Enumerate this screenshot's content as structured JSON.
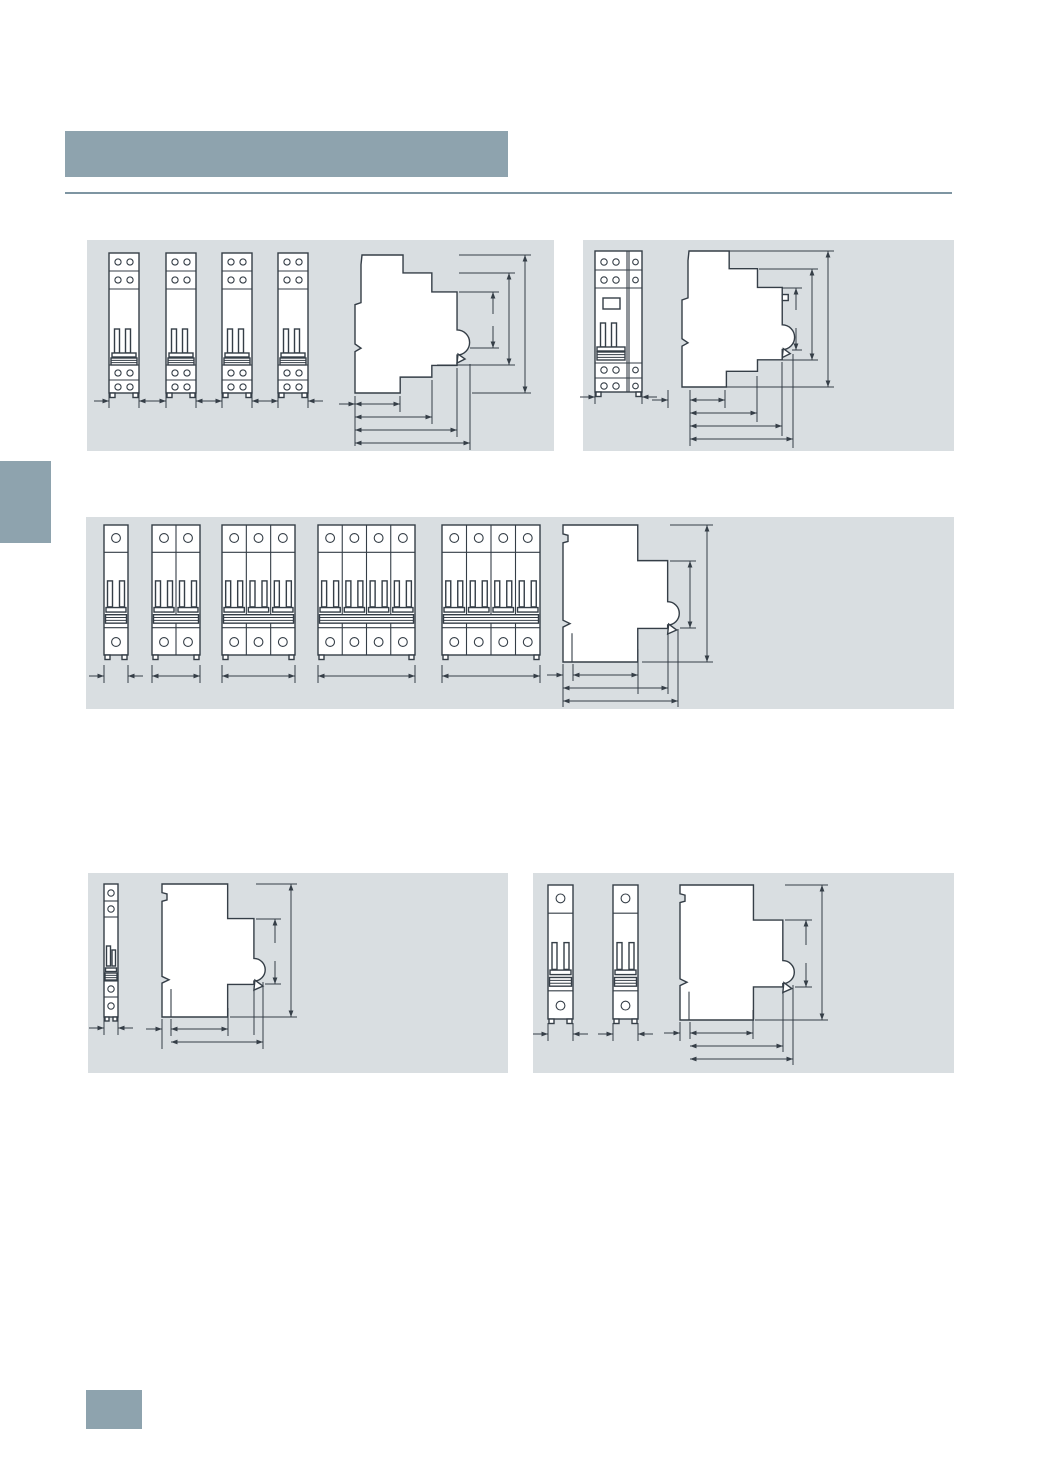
{
  "page": {
    "width": 1041,
    "height": 1472,
    "background": "#ffffff"
  },
  "colors": {
    "accent_block": "#8ea3ae",
    "panel_background": "#d9dee1",
    "rule_line": "#7e95a2",
    "drawing_line": "#353e47",
    "drawing_fill": "#ffffff"
  },
  "header": {
    "title_bar": {
      "x": 65,
      "y": 131,
      "w": 443,
      "h": 46
    },
    "rule": {
      "x": 65,
      "y": 192,
      "w": 887
    }
  },
  "side_tab": {
    "x": 0,
    "y": 461,
    "w": 51,
    "h": 82
  },
  "page_marker": {
    "x": 86,
    "y": 1390,
    "w": 56,
    "h": 39
  },
  "panels": [
    {
      "id": "top-left",
      "box": {
        "x": 87,
        "y": 240,
        "w": 467,
        "h": 211
      },
      "figures": [
        {
          "kind": "front",
          "style": "dd",
          "x": 22,
          "y": 13,
          "w": 30,
          "h": 140
        },
        {
          "kind": "front",
          "style": "dd",
          "x": 79,
          "y": 13,
          "w": 30,
          "h": 140
        },
        {
          "kind": "front",
          "style": "dd",
          "x": 135,
          "y": 13,
          "w": 30,
          "h": 140
        },
        {
          "kind": "front",
          "style": "dd",
          "x": 191,
          "y": 13,
          "w": 30,
          "h": 140
        },
        {
          "kind": "profile",
          "variant": "rcbo",
          "x": 268,
          "y": 15,
          "w": 113,
          "h": 138,
          "button": false
        }
      ],
      "dims": [
        {
          "t": "ext",
          "x": 22,
          "y1": 150,
          "y2": 168
        },
        {
          "t": "ext",
          "x": 52,
          "y1": 150,
          "y2": 168
        },
        {
          "t": "ext",
          "x": 79,
          "y1": 150,
          "y2": 168
        },
        {
          "t": "ext",
          "x": 109,
          "y1": 150,
          "y2": 168
        },
        {
          "t": "ext",
          "x": 135,
          "y1": 150,
          "y2": 168
        },
        {
          "t": "ext",
          "x": 165,
          "y1": 150,
          "y2": 168
        },
        {
          "t": "ext",
          "x": 191,
          "y1": 150,
          "y2": 168
        },
        {
          "t": "ext",
          "x": 221,
          "y1": 150,
          "y2": 168
        },
        {
          "t": "h",
          "mode": "out",
          "x1": 22,
          "x2": 52,
          "y": 161
        },
        {
          "t": "h",
          "mode": "out",
          "x1": 79,
          "x2": 109,
          "y": 161
        },
        {
          "t": "h",
          "mode": "out",
          "x1": 135,
          "x2": 165,
          "y": 161
        },
        {
          "t": "h",
          "mode": "out",
          "x1": 191,
          "x2": 221,
          "y": 161
        },
        {
          "t": "href",
          "x1": 372,
          "y1": 15,
          "x2": 444,
          "y2": 15
        },
        {
          "t": "href",
          "x1": 385,
          "y1": 153,
          "x2": 444,
          "y2": 153
        },
        {
          "t": "href",
          "x1": 372,
          "y1": 33,
          "x2": 428,
          "y2": 33
        },
        {
          "t": "href",
          "x1": 350,
          "y1": 125,
          "x2": 428,
          "y2": 125
        },
        {
          "t": "href",
          "x1": 372,
          "y1": 52,
          "x2": 412,
          "y2": 52
        },
        {
          "t": "href",
          "x1": 383,
          "y1": 108,
          "x2": 412,
          "y2": 108
        },
        {
          "t": "v",
          "x": 438,
          "y1": 15,
          "y2": 153,
          "heads": "both"
        },
        {
          "t": "v",
          "x": 422,
          "y1": 33,
          "y2": 125,
          "heads": "both"
        },
        {
          "t": "v",
          "x": 406,
          "y1": 52,
          "y2": 74,
          "heads": "top"
        },
        {
          "t": "v",
          "x": 406,
          "y1": 86,
          "y2": 108,
          "heads": "bottom"
        },
        {
          "t": "ext",
          "x": 268,
          "y1": 156,
          "y2": 206
        },
        {
          "t": "ext",
          "x": 313,
          "y1": 156,
          "y2": 172
        },
        {
          "t": "ext",
          "x": 345,
          "y1": 140,
          "y2": 184
        },
        {
          "t": "ext",
          "x": 370,
          "y1": 128,
          "y2": 197
        },
        {
          "t": "ext",
          "x": 383,
          "y1": 124,
          "y2": 210
        },
        {
          "t": "h",
          "mode": "right",
          "x1": 252,
          "x2": 268,
          "y": 164
        },
        {
          "t": "h",
          "mode": "in",
          "x1": 268,
          "x2": 313,
          "y": 164
        },
        {
          "t": "h",
          "mode": "in",
          "x1": 268,
          "x2": 345,
          "y": 177
        },
        {
          "t": "h",
          "mode": "in",
          "x1": 268,
          "x2": 370,
          "y": 190
        },
        {
          "t": "h",
          "mode": "in",
          "x1": 268,
          "x2": 383,
          "y": 203
        }
      ]
    },
    {
      "id": "top-right",
      "box": {
        "x": 583,
        "y": 240,
        "w": 371,
        "h": 211
      },
      "figures": [
        {
          "kind": "front",
          "style": "rcbo",
          "x": 12,
          "y": 11,
          "w": 47,
          "h": 141
        },
        {
          "kind": "profile",
          "variant": "rcbo",
          "x": 99,
          "y": 11,
          "w": 111,
          "h": 136,
          "button": true
        }
      ],
      "dims": [
        {
          "t": "ext",
          "x": 12,
          "y1": 148,
          "y2": 164
        },
        {
          "t": "ext",
          "x": 59,
          "y1": 148,
          "y2": 164
        },
        {
          "t": "h",
          "mode": "out",
          "x1": 12,
          "x2": 59,
          "y": 157
        },
        {
          "t": "href",
          "x1": 146,
          "y1": 11,
          "x2": 251,
          "y2": 11
        },
        {
          "t": "href",
          "x1": 144,
          "y1": 147,
          "x2": 251,
          "y2": 147
        },
        {
          "t": "href",
          "x1": 176,
          "y1": 29,
          "x2": 235,
          "y2": 29
        },
        {
          "t": "href",
          "x1": 176,
          "y1": 120,
          "x2": 235,
          "y2": 120
        },
        {
          "t": "href",
          "x1": 199,
          "y1": 48,
          "x2": 219,
          "y2": 48
        },
        {
          "t": "href",
          "x1": 209,
          "y1": 110,
          "x2": 219,
          "y2": 110
        },
        {
          "t": "v",
          "x": 245,
          "y1": 11,
          "y2": 147,
          "heads": "both"
        },
        {
          "t": "v",
          "x": 229,
          "y1": 29,
          "y2": 120,
          "heads": "both"
        },
        {
          "t": "v",
          "x": 213,
          "y1": 48,
          "y2": 70,
          "heads": "top"
        },
        {
          "t": "v",
          "x": 213,
          "y1": 88,
          "y2": 110,
          "heads": "bottom"
        },
        {
          "t": "ext",
          "x": 85,
          "y1": 150,
          "y2": 168
        },
        {
          "t": "ext",
          "x": 107,
          "y1": 150,
          "y2": 206
        },
        {
          "t": "ext",
          "x": 142,
          "y1": 150,
          "y2": 168
        },
        {
          "t": "ext",
          "x": 174,
          "y1": 136,
          "y2": 182
        },
        {
          "t": "ext",
          "x": 199,
          "y1": 122,
          "y2": 196
        },
        {
          "t": "ext",
          "x": 210,
          "y1": 114,
          "y2": 208
        },
        {
          "t": "h",
          "mode": "right",
          "x1": 69,
          "x2": 85,
          "y": 160
        },
        {
          "t": "h",
          "mode": "in",
          "x1": 107,
          "x2": 142,
          "y": 160
        },
        {
          "t": "h",
          "mode": "in",
          "x1": 107,
          "x2": 174,
          "y": 173
        },
        {
          "t": "h",
          "mode": "in",
          "x1": 107,
          "x2": 199,
          "y": 186
        },
        {
          "t": "h",
          "mode": "in",
          "x1": 107,
          "x2": 210,
          "y": 199
        }
      ]
    },
    {
      "id": "middle",
      "box": {
        "x": 86,
        "y": 517,
        "w": 868,
        "h": 192
      },
      "figures": [
        {
          "kind": "front",
          "style": "std",
          "x": 18,
          "y": 8,
          "w": 24,
          "h": 130,
          "modules": 1
        },
        {
          "kind": "front",
          "style": "std",
          "x": 66,
          "y": 8,
          "w": 48,
          "h": 130,
          "modules": 2
        },
        {
          "kind": "front",
          "style": "std",
          "x": 136,
          "y": 8,
          "w": 73,
          "h": 130,
          "modules": 3
        },
        {
          "kind": "front",
          "style": "std",
          "x": 232,
          "y": 8,
          "w": 97,
          "h": 130,
          "modules": 4
        },
        {
          "kind": "front",
          "style": "std",
          "x": 356,
          "y": 8,
          "w": 98,
          "h": 130,
          "modules": 4
        },
        {
          "kind": "profile",
          "variant": "mcb",
          "x": 477,
          "y": 8,
          "w": 115,
          "h": 137,
          "button": false
        }
      ],
      "dims": [
        {
          "t": "ext",
          "x": 18,
          "y1": 148,
          "y2": 166
        },
        {
          "t": "ext",
          "x": 42,
          "y1": 148,
          "y2": 166
        },
        {
          "t": "ext",
          "x": 66,
          "y1": 148,
          "y2": 166
        },
        {
          "t": "ext",
          "x": 114,
          "y1": 148,
          "y2": 166
        },
        {
          "t": "ext",
          "x": 136,
          "y1": 148,
          "y2": 166
        },
        {
          "t": "ext",
          "x": 209,
          "y1": 148,
          "y2": 166
        },
        {
          "t": "ext",
          "x": 232,
          "y1": 148,
          "y2": 166
        },
        {
          "t": "ext",
          "x": 329,
          "y1": 148,
          "y2": 166
        },
        {
          "t": "ext",
          "x": 356,
          "y1": 148,
          "y2": 166
        },
        {
          "t": "ext",
          "x": 454,
          "y1": 148,
          "y2": 166
        },
        {
          "t": "h",
          "mode": "out",
          "x1": 18,
          "x2": 42,
          "y": 159
        },
        {
          "t": "h",
          "mode": "in",
          "x1": 66,
          "x2": 114,
          "y": 159
        },
        {
          "t": "h",
          "mode": "in",
          "x1": 136,
          "x2": 209,
          "y": 159
        },
        {
          "t": "h",
          "mode": "in",
          "x1": 232,
          "x2": 329,
          "y": 159
        },
        {
          "t": "h",
          "mode": "in",
          "x1": 356,
          "x2": 454,
          "y": 159
        },
        {
          "t": "href",
          "x1": 584,
          "y1": 8,
          "x2": 627,
          "y2": 8
        },
        {
          "t": "href",
          "x1": 556,
          "y1": 145,
          "x2": 627,
          "y2": 145
        },
        {
          "t": "href",
          "x1": 584,
          "y1": 44,
          "x2": 610,
          "y2": 44
        },
        {
          "t": "href",
          "x1": 594,
          "y1": 111,
          "x2": 610,
          "y2": 111
        },
        {
          "t": "v",
          "x": 621,
          "y1": 8,
          "y2": 145,
          "heads": "both"
        },
        {
          "t": "v",
          "x": 604,
          "y1": 44,
          "y2": 111,
          "heads": "both"
        },
        {
          "t": "ext",
          "x": 477,
          "y1": 147,
          "y2": 190
        },
        {
          "t": "ext",
          "x": 487,
          "y1": 147,
          "y2": 164
        },
        {
          "t": "ext",
          "x": 552,
          "y1": 132,
          "y2": 177
        },
        {
          "t": "ext",
          "x": 582,
          "y1": 113,
          "y2": 177
        },
        {
          "t": "ext",
          "x": 592,
          "y1": 112,
          "y2": 190
        },
        {
          "t": "h",
          "mode": "right",
          "x1": 461,
          "x2": 477,
          "y": 158
        },
        {
          "t": "h",
          "mode": "in",
          "x1": 487,
          "x2": 552,
          "y": 158
        },
        {
          "t": "h",
          "mode": "in",
          "x1": 477,
          "x2": 582,
          "y": 171
        },
        {
          "t": "h",
          "mode": "in",
          "x1": 477,
          "x2": 592,
          "y": 184
        }
      ]
    },
    {
      "id": "bottom-left",
      "box": {
        "x": 88,
        "y": 873,
        "w": 420,
        "h": 200
      },
      "figures": [
        {
          "kind": "front",
          "style": "half",
          "x": 16,
          "y": 11,
          "w": 14,
          "h": 133
        },
        {
          "kind": "profile",
          "variant": "mcb",
          "x": 74,
          "y": 11,
          "w": 101,
          "h": 133,
          "button": false
        }
      ],
      "dims": [
        {
          "t": "ext",
          "x": 16,
          "y1": 143,
          "y2": 162
        },
        {
          "t": "ext",
          "x": 30,
          "y1": 143,
          "y2": 162
        },
        {
          "t": "h",
          "mode": "out",
          "x1": 16,
          "x2": 30,
          "y": 155
        },
        {
          "t": "href",
          "x1": 168,
          "y1": 11,
          "x2": 209,
          "y2": 11
        },
        {
          "t": "href",
          "x1": 142,
          "y1": 144,
          "x2": 209,
          "y2": 144
        },
        {
          "t": "href",
          "x1": 168,
          "y1": 46,
          "x2": 193,
          "y2": 46
        },
        {
          "t": "href",
          "x1": 177,
          "y1": 111,
          "x2": 193,
          "y2": 111
        },
        {
          "t": "v",
          "x": 203,
          "y1": 11,
          "y2": 144,
          "heads": "both"
        },
        {
          "t": "v",
          "x": 187,
          "y1": 46,
          "y2": 70,
          "heads": "top"
        },
        {
          "t": "v",
          "x": 187,
          "y1": 88,
          "y2": 111,
          "heads": "bottom"
        },
        {
          "t": "ext",
          "x": 74,
          "y1": 146,
          "y2": 176
        },
        {
          "t": "ext",
          "x": 83,
          "y1": 146,
          "y2": 163
        },
        {
          "t": "ext",
          "x": 140,
          "y1": 135,
          "y2": 163
        },
        {
          "t": "ext",
          "x": 166,
          "y1": 113,
          "y2": 162
        },
        {
          "t": "ext",
          "x": 175,
          "y1": 109,
          "y2": 176
        },
        {
          "t": "h",
          "mode": "right",
          "x1": 58,
          "x2": 74,
          "y": 156
        },
        {
          "t": "h",
          "mode": "in",
          "x1": 83,
          "x2": 140,
          "y": 156
        },
        {
          "t": "h",
          "mode": "in",
          "x1": 83,
          "x2": 175,
          "y": 169
        }
      ]
    },
    {
      "id": "bottom-right",
      "box": {
        "x": 533,
        "y": 873,
        "w": 421,
        "h": 200
      },
      "figures": [
        {
          "kind": "front",
          "style": "std",
          "x": 15,
          "y": 12,
          "w": 25,
          "h": 134,
          "modules": 1
        },
        {
          "kind": "front",
          "style": "std",
          "x": 80,
          "y": 12,
          "w": 25,
          "h": 134,
          "modules": 1
        },
        {
          "kind": "profile",
          "variant": "mcb",
          "x": 147,
          "y": 12,
          "w": 113,
          "h": 135,
          "button": false
        }
      ],
      "dims": [
        {
          "t": "ext",
          "x": 15,
          "y1": 150,
          "y2": 168
        },
        {
          "t": "ext",
          "x": 40,
          "y1": 150,
          "y2": 168
        },
        {
          "t": "ext",
          "x": 80,
          "y1": 150,
          "y2": 168
        },
        {
          "t": "ext",
          "x": 105,
          "y1": 150,
          "y2": 168
        },
        {
          "t": "h",
          "mode": "out",
          "x1": 15,
          "x2": 40,
          "y": 161
        },
        {
          "t": "h",
          "mode": "out",
          "x1": 80,
          "x2": 105,
          "y": 161
        },
        {
          "t": "href",
          "x1": 252,
          "y1": 12,
          "x2": 295,
          "y2": 12
        },
        {
          "t": "href",
          "x1": 222,
          "y1": 147,
          "x2": 295,
          "y2": 147
        },
        {
          "t": "href",
          "x1": 252,
          "y1": 47,
          "x2": 279,
          "y2": 47
        },
        {
          "t": "href",
          "x1": 262,
          "y1": 114,
          "x2": 279,
          "y2": 114
        },
        {
          "t": "v",
          "x": 289,
          "y1": 12,
          "y2": 147,
          "heads": "both"
        },
        {
          "t": "v",
          "x": 273,
          "y1": 47,
          "y2": 72,
          "heads": "top"
        },
        {
          "t": "v",
          "x": 273,
          "y1": 90,
          "y2": 114,
          "heads": "bottom"
        },
        {
          "t": "ext",
          "x": 147,
          "y1": 149,
          "y2": 168
        },
        {
          "t": "ext",
          "x": 157,
          "y1": 149,
          "y2": 166
        },
        {
          "t": "ext",
          "x": 220,
          "y1": 137,
          "y2": 166
        },
        {
          "t": "ext",
          "x": 250,
          "y1": 116,
          "y2": 179
        },
        {
          "t": "ext",
          "x": 260,
          "y1": 112,
          "y2": 192
        },
        {
          "t": "h",
          "mode": "right",
          "x1": 131,
          "x2": 147,
          "y": 160
        },
        {
          "t": "h",
          "mode": "in",
          "x1": 157,
          "x2": 220,
          "y": 160
        },
        {
          "t": "h",
          "mode": "in",
          "x1": 157,
          "x2": 250,
          "y": 173
        },
        {
          "t": "h",
          "mode": "in",
          "x1": 157,
          "x2": 260,
          "y": 186
        }
      ]
    }
  ]
}
